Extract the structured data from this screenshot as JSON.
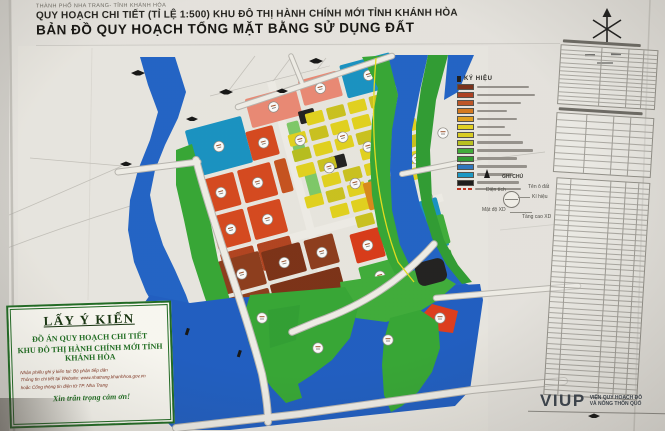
{
  "header": {
    "line1": "THÀNH PHỐ NHA TRANG- TỈNH KHÁNH HÒA",
    "line2": "QUY HOẠCH CHI TIẾT (TỈ LỆ 1:500) KHU ĐÔ THỊ HÀNH CHÍNH MỚI TỈNH KHÁNH HÒA",
    "line3": "BẢN ĐỒ QUY HOẠCH TỔNG MẶT BẰNG SỬ DỤNG ĐẤT"
  },
  "legend": {
    "title": "KÝ HIỆU",
    "swatch_colors": [
      "#7a2f1a",
      "#b04020",
      "#c05525",
      "#d97b1e",
      "#e5a31e",
      "#e6d51f",
      "#ddd020",
      "#bcc41e",
      "#3fae3a",
      "#2f9e33",
      "#2e77c0",
      "#189ac8",
      "#1a1a1a"
    ],
    "boundary_color": "#c23320"
  },
  "notes": {
    "title": "GHI CHÚ",
    "area_label": "Diện tích",
    "lot_label": "Tên ô đất",
    "symbol_label": "Kí hiệu",
    "density_label": "Mật độ XD",
    "height_label": "Tầng cao XD"
  },
  "consultation": {
    "title": "LẤY Ý KIẾN",
    "line2": "ĐỒ ÁN QUY HOẠCH CHI TIẾT",
    "line3": "KHU ĐÔ THỊ HÀNH CHÍNH MỚI TỈNH KHÁNH HÒA",
    "note1": "Nhận phiếu ghi ý kiến tại: Bộ phận tiếp dân",
    "note2": "Thông tin chi tiết tại Website: www.nhatrang.khanhhoa.gov.vn",
    "note3": "hoặc Cổng thông tin điện tử TP. Nha Trang",
    "thanks": "Xin trân trọng cảm ơn!"
  },
  "publisher": {
    "logo": "VIUP",
    "org_line1": "VIỆN QUY HOẠCH ĐÔ",
    "org_line2": "VÀ NÔNG THÔN QUỐ"
  },
  "map_colors": {
    "water": "#2064c8",
    "park_green": "#35a835",
    "dark_green": "#2f9e33",
    "public_teal": "#1794c4",
    "residential_red": "#d8481e",
    "mixed_maroon": "#8e3c1c",
    "maroon_dark": "#7c3116",
    "salmon": "#ed8a75",
    "yellow_lot": "#e4d41d",
    "olive_lot": "#ccc41e",
    "orange_lot": "#db8b1a",
    "black_lot": "#202020",
    "road": "#f2f0ea"
  }
}
